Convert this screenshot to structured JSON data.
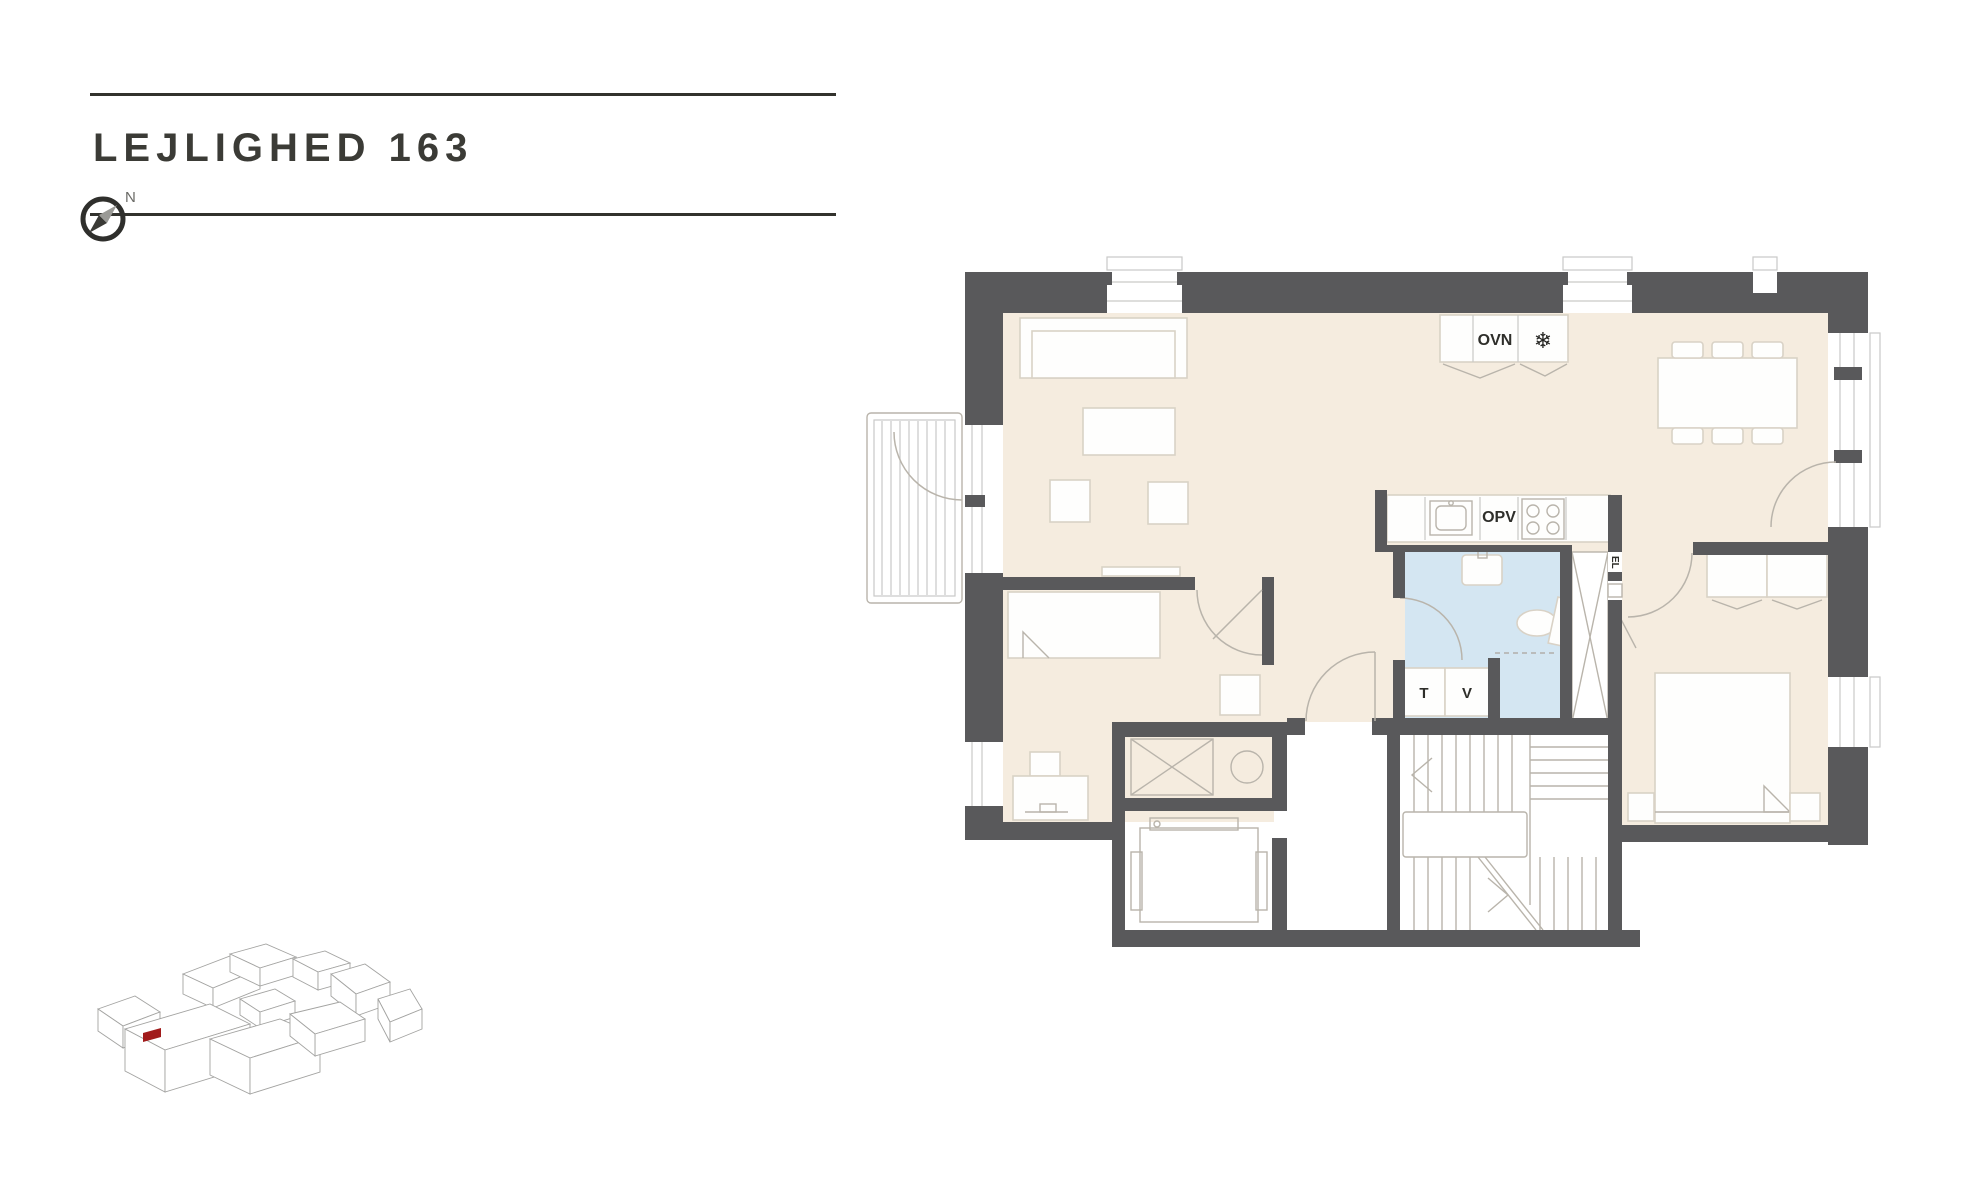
{
  "header": {
    "title": "LEJLIGHED 163"
  },
  "compass": {
    "north": "N"
  },
  "plan_labels": {
    "oven": "OVN",
    "freezer_icon": "❄",
    "dishwasher": "OPV",
    "dryer": "T",
    "washer": "V",
    "electrical": "EL"
  },
  "colors": {
    "wall": "#59595b",
    "floor": "#f5ecdf",
    "bath": "#d4e6f2",
    "accent": "#a11b1b",
    "ink": "#32322d"
  }
}
